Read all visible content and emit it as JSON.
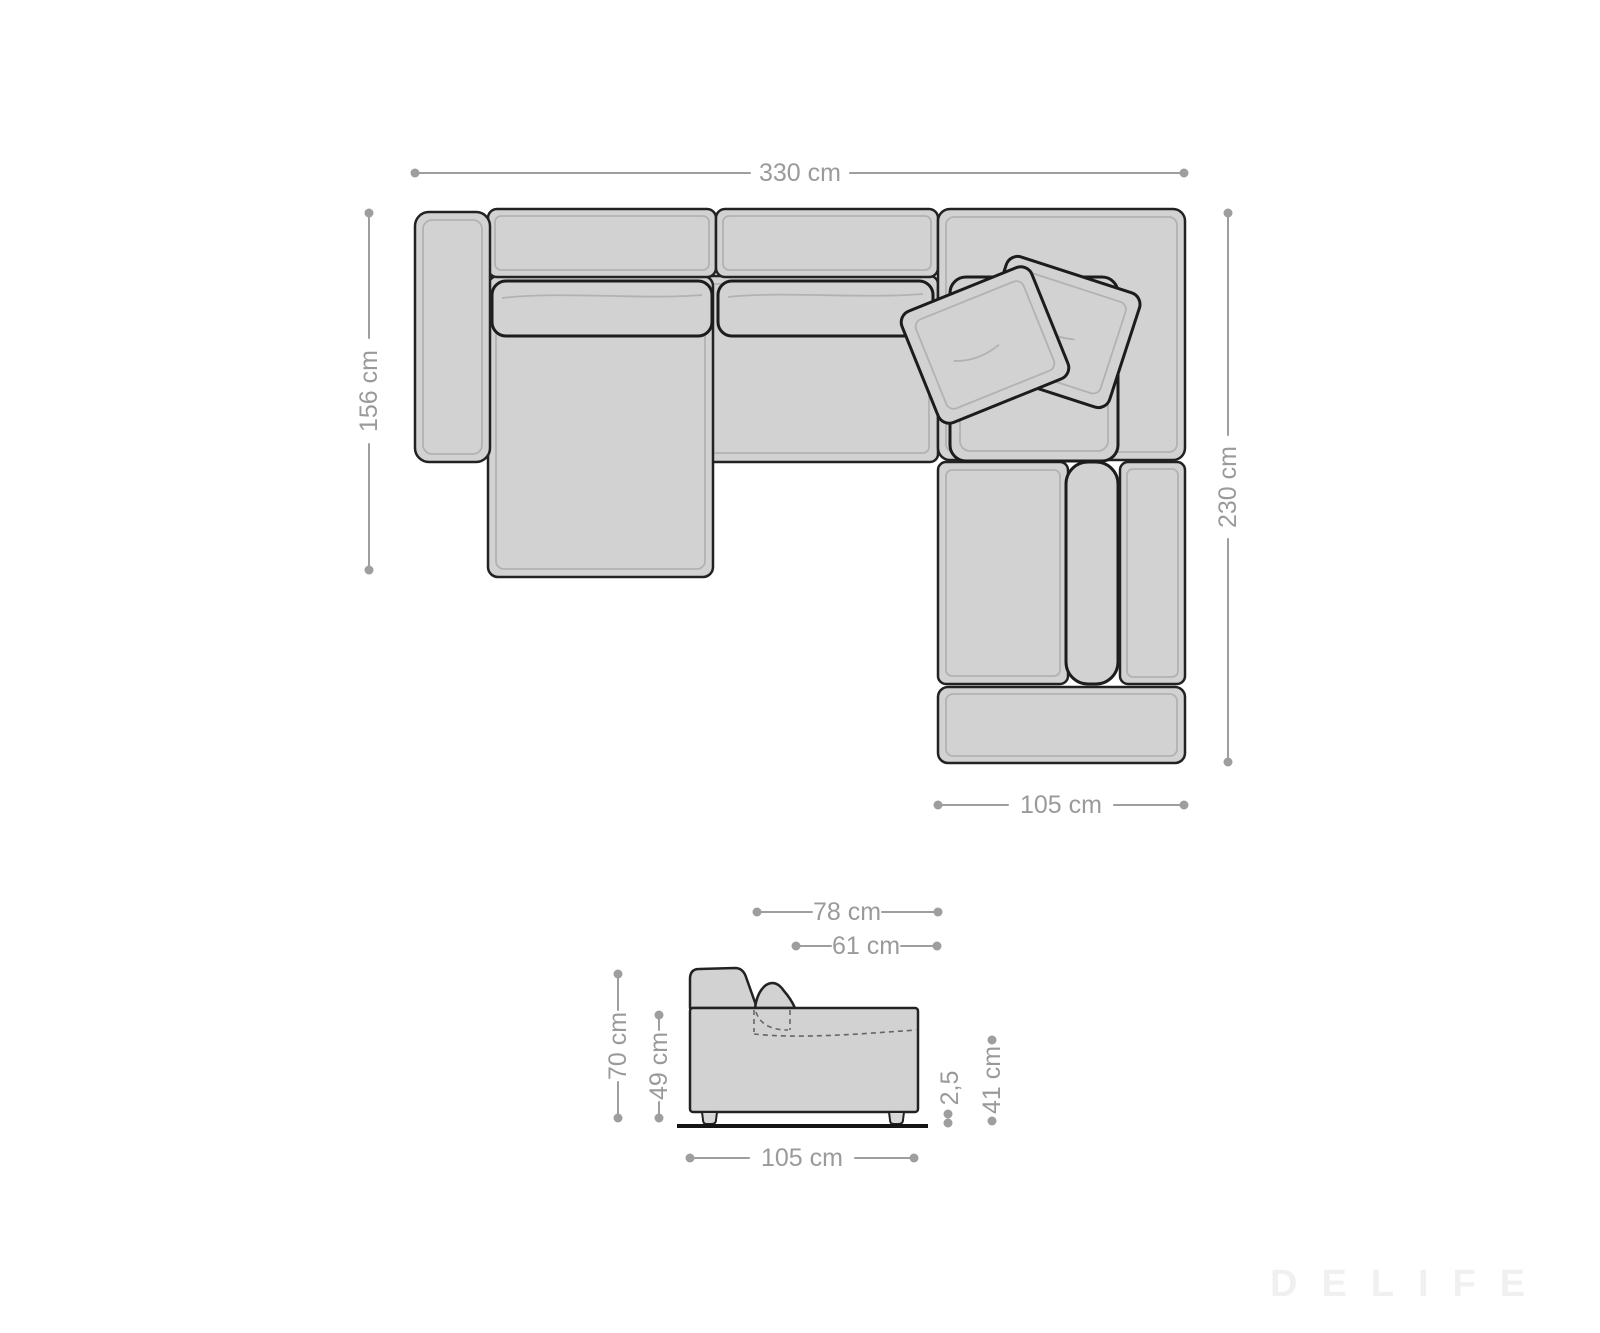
{
  "top_view": {
    "total_width": "330 cm",
    "chaise_depth": "156 cm",
    "right_depth": "230 cm",
    "right_width": "105 cm"
  },
  "side_view": {
    "depth_top": "78 cm",
    "depth_inner": "61 cm",
    "height_total": "70 cm",
    "height_body": "49 cm",
    "clearance": "2,5",
    "seat_height": "41 cm",
    "width_bottom": "105 cm"
  },
  "watermark": "DELIFE",
  "colors": {
    "background": "#ffffff",
    "dimension_gray": "#9e9e9e",
    "sofa_fill": "#d2d2d2",
    "sofa_outline": "#222222",
    "inner_stitch": "#b2b2b2",
    "watermark_gray": "#f0f0f0"
  }
}
